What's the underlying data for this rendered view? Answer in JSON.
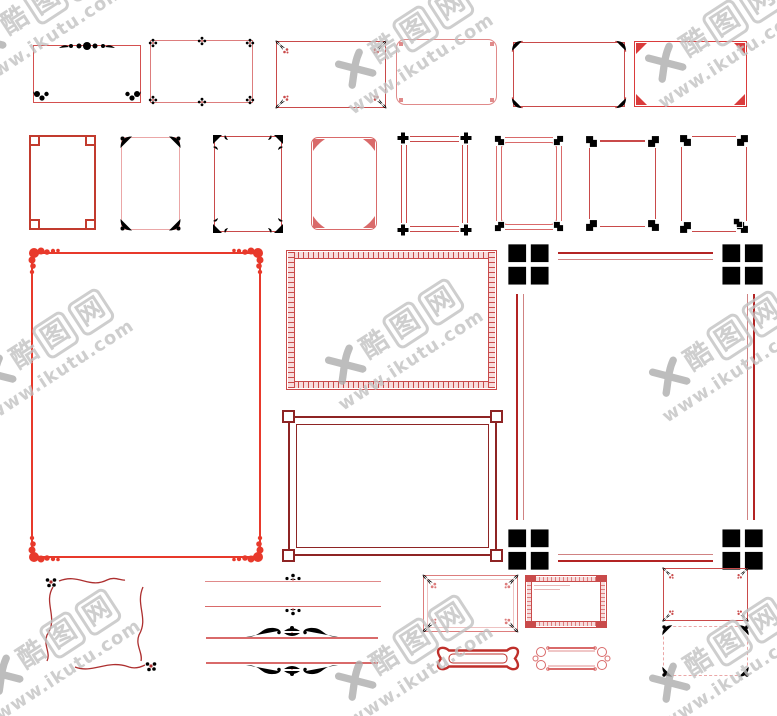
{
  "watermark": {
    "chars": [
      "酷",
      "图",
      "网"
    ],
    "url": "www.ikutu.com"
  },
  "palette": {
    "background": "#ffffff",
    "bright_red": "#e8392b",
    "vivid_red": "#da3b3b",
    "coral_red": "#d4504f",
    "mid_red": "#c94a4a",
    "brick_red": "#c23b2e",
    "soft_red": "#d96a6a",
    "light_red": "#dd7d7d",
    "rose": "#e08a8a",
    "pink": "#eba7a7",
    "band_pink": "#f7dcdc",
    "dark_red": "#8e2424",
    "deep_red": "#b32424",
    "banner_red": "#bf2f2a",
    "maroon": "#ad2f2f",
    "wm_gray": "#c2c2c2",
    "wm_dark": "#adadad"
  }
}
